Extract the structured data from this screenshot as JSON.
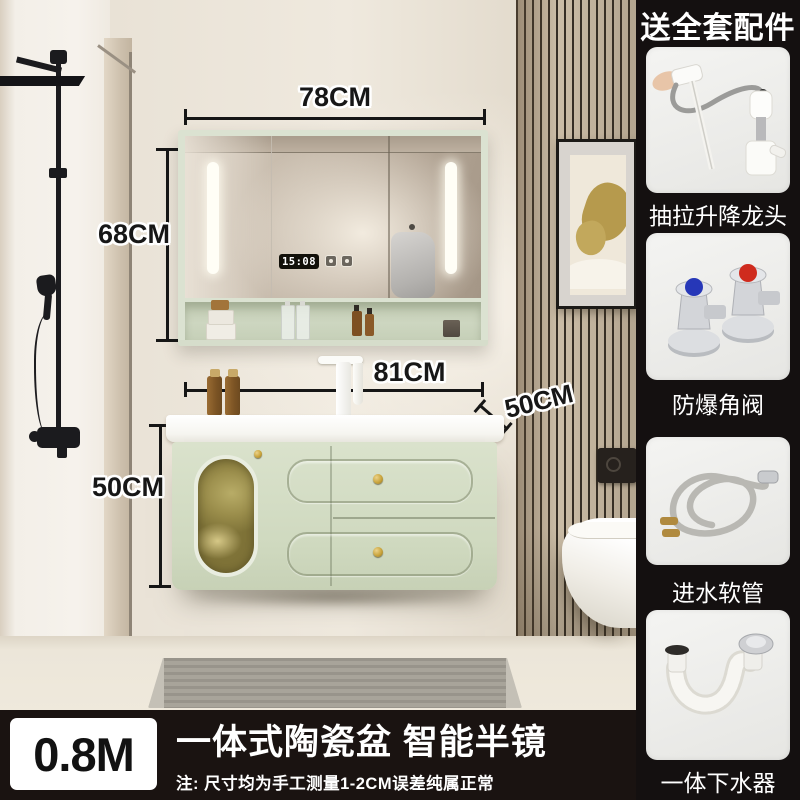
{
  "sidebar": {
    "header": "送全套配件",
    "items": [
      {
        "label": "抽拉升降龙头"
      },
      {
        "label": "防爆角阀"
      },
      {
        "label": "进水软管"
      },
      {
        "label": "一体下水器"
      }
    ]
  },
  "annotations": {
    "mirror_width": "78CM",
    "mirror_height": "68CM",
    "basin_width": "81CM",
    "basin_depth": "50CM",
    "cabinet_height": "50CM"
  },
  "mirror": {
    "clock": "15:08"
  },
  "banner": {
    "size": "0.8M",
    "title": "一体式陶瓷盆 智能半镜",
    "note": "注: 尺寸均为手工测量1-2CM误差纯属正常"
  },
  "colors": {
    "sidebar_bg": "#141010",
    "banner_bg": "#1a1311",
    "cabinet_green": "#d3dcc6",
    "mirror_frame_green": "#dbe2d1",
    "gold_hardware": "#c9a43c",
    "valve_cold_cap": "#2637b8",
    "valve_hot_cap": "#cf2b1e"
  }
}
